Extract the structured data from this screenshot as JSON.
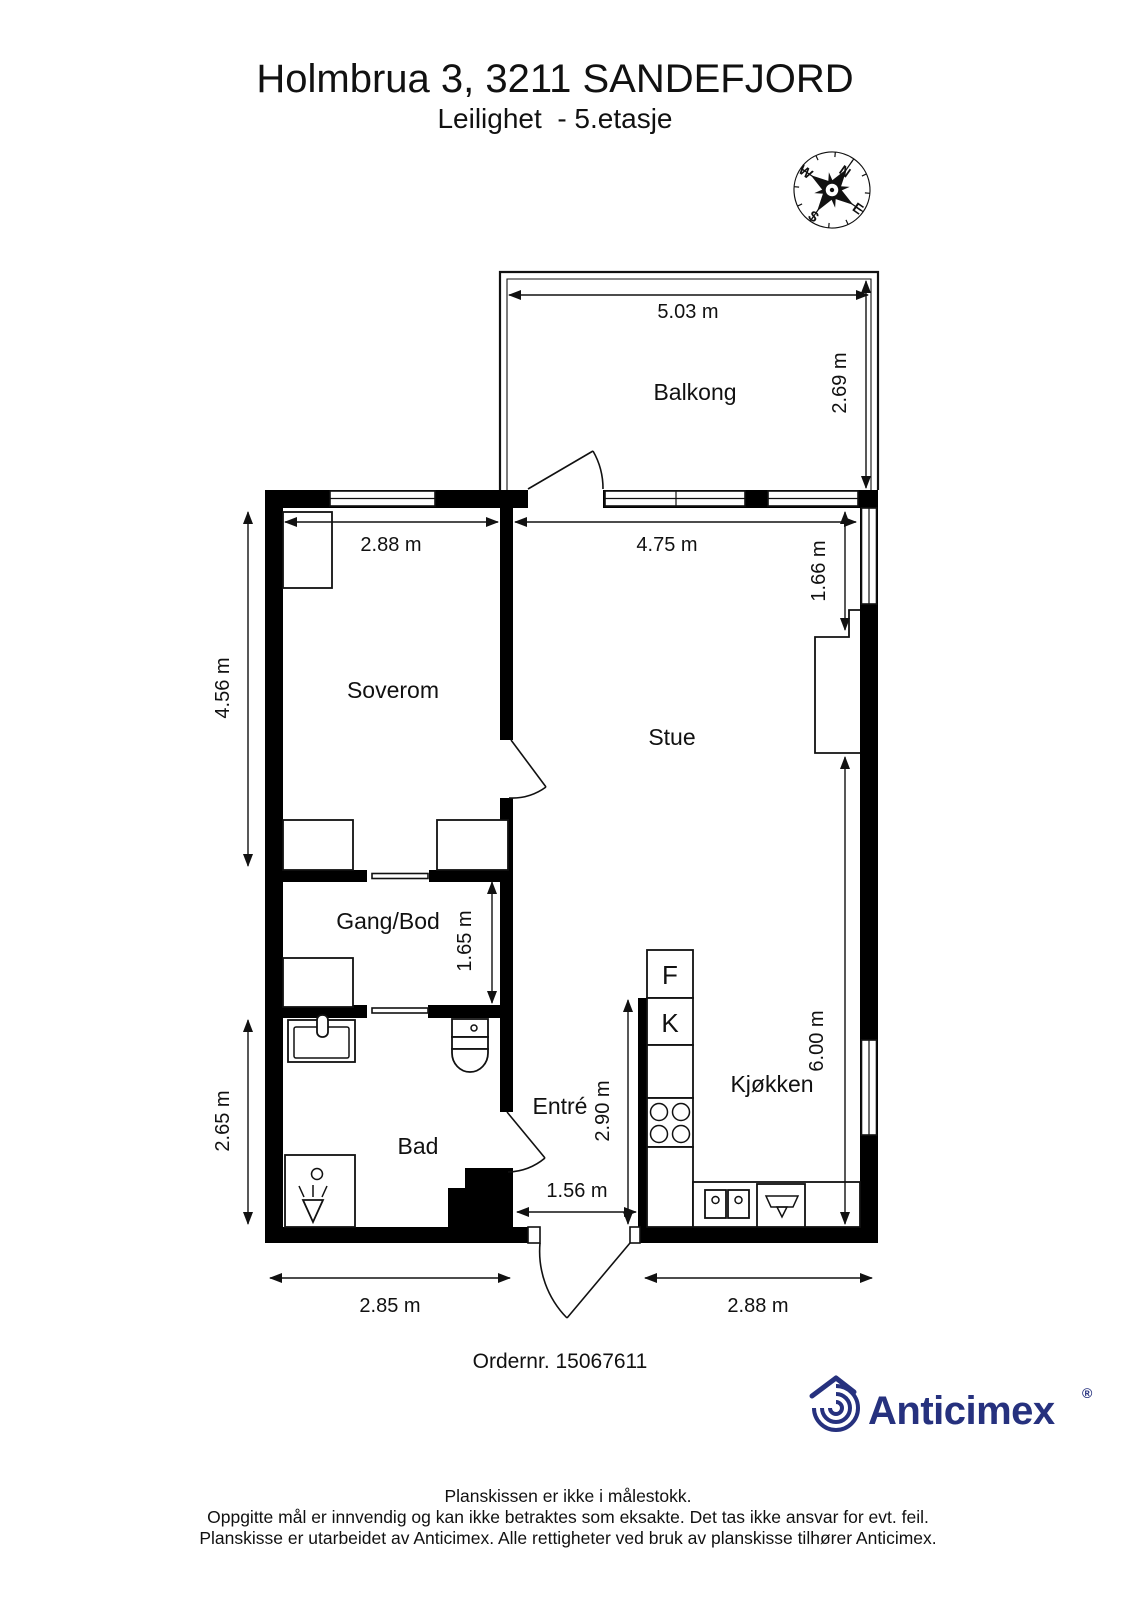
{
  "header": {
    "title": "Holmbrua 3, 3211 SANDEFJORD",
    "subtitle": "Leilighet  - 5.etasje"
  },
  "compass": {
    "north": "N",
    "east": "E",
    "south": "S",
    "west": "W"
  },
  "rooms": {
    "balcony": "Balkong",
    "bedroom": "Soverom",
    "living_room": "Stue",
    "hallway": "Gang/Bod",
    "bathroom": "Bad",
    "entrance": "Entré",
    "kitchen": "Kjøkken"
  },
  "kitchen_units": {
    "fridge_label": "F",
    "cooler_label": "K"
  },
  "dimensions": {
    "balcony_width": "5.03 m",
    "balcony_depth": "2.69 m",
    "bedroom_width": "2.88 m",
    "bedroom_length": "4.56 m",
    "living_room_width": "4.75 m",
    "living_room_recess": "1.66 m",
    "living_room_length": "6.00 m",
    "hallway_length": "1.65 m",
    "bathroom_length": "2.65 m",
    "bathroom_width": "2.85 m",
    "entrance_length": "2.90 m",
    "entrance_width": "1.56 m",
    "kitchen_width": "2.88 m"
  },
  "order": {
    "number_label": "Ordernr. 15067611"
  },
  "branding": {
    "name": "Anticimex",
    "registered_symbol": "®",
    "brand_color": "#26317e"
  },
  "footer": {
    "line1": "Planskissen er ikke i målestokk.",
    "line2": "Oppgitte mål er innvendig og kan ikke betraktes som eksakte. Det tas ikke ansvar for evt. feil.",
    "line3": "Planskisse er utarbeidet av Anticimex. Alle rettigheter ved bruk av planskisse tilhører Anticimex."
  }
}
